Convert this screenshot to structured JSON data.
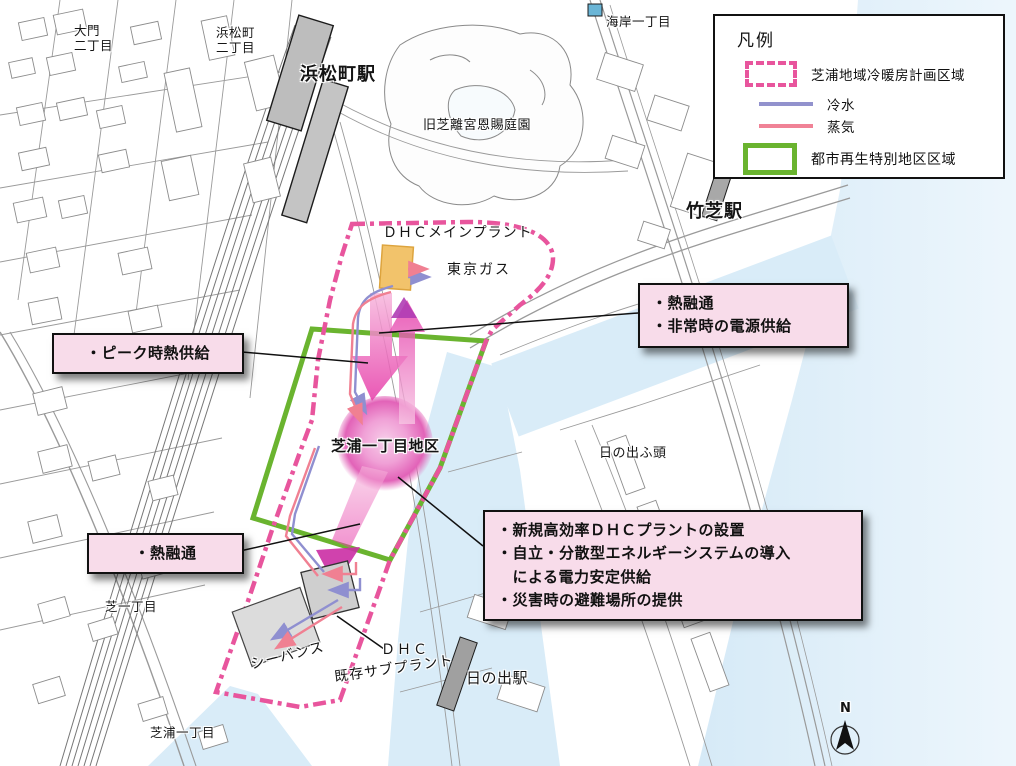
{
  "legend": {
    "title": "凡例",
    "items": [
      {
        "label": "芝浦地域冷暖房計画区域",
        "swatch": "pink-dash-rect-icon"
      },
      {
        "label": "冷水",
        "swatch": "blue-line-icon"
      },
      {
        "label": "蒸気",
        "swatch": "pink-line-icon"
      },
      {
        "label": "都市再生特別地区区域",
        "swatch": "green-rect-icon"
      }
    ]
  },
  "labels": {
    "daimon2": "大門\n二丁目",
    "hamamatsucho2": "浜松町\n二丁目",
    "hamamatsucho_sta": "浜松町駅",
    "kyushiba_garden": "旧芝離宮恩賜庭園",
    "kaigan1": "海岸一丁目",
    "takeshiba_sta": "竹芝駅",
    "dhc_main_plant": "ＤＨＣメインプラント",
    "tokyo_gas": "東京ガス",
    "shibaura1_district": "芝浦一丁目地区",
    "hinode_pier": "日の出ふ頭",
    "seavans": "シーバンス",
    "dhc": "ＤＨＣ",
    "existing_subplant": "既存サブプラント",
    "hinode_sta": "日の出駅",
    "shiba1": "芝一丁目",
    "shibaura1": "芝浦一丁目",
    "compass_n": "N"
  },
  "callouts": {
    "peak_heat": "・ピーク時熱供給",
    "heat_interchange_left": "・熱融通",
    "heat_interchange_right": "・熱融通\n・非常時の電源供給",
    "new_plant": "・新規高効率ＤＨＣプラントの設置\n・自立・分散型エネルギーシステムの導入\n　による電力安定供給\n・災害時の避難場所の提供"
  },
  "colors": {
    "plan_boundary": "#e8559d",
    "cold_water": "#9292cd",
    "steam": "#f08296",
    "special_district": "#6ab42f",
    "callout_bg": "#f8dcea",
    "water": "#d9ecf8",
    "plant_fill": "#f2c36b",
    "flow_arrow": "#e62fa4"
  }
}
